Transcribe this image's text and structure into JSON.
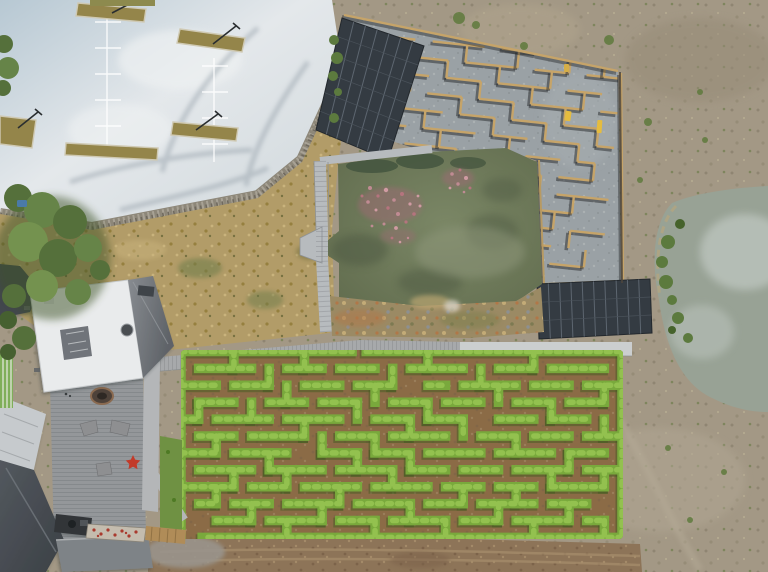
{
  "image": {
    "kind": "aerial-drone-photograph",
    "subject": "maze park seen from above: car park, timber panel maze with solar arrays, green pond with pink water plants, hedge maze with dirt paths, visitor buildings and deck, dry paddock with second pond",
    "width": 768,
    "height": 572
  },
  "colors": {
    "field_base": "#a39885",
    "field_dark": "#8c826f",
    "field_green": "#6d7c4a",
    "parking_light": "#e2e7ea",
    "parking_blue": "#b7c8d3",
    "parking_line": "#ffffff",
    "planter": "#94854a",
    "planter_curb": "#cfc9b3",
    "pole": "#2a2e30",
    "rock_wall": "#8d8779",
    "dry_grass": "#b29c68",
    "tree_green": "#55703b",
    "tree_light": "#6d8a4a",
    "maze_concrete": "#9aa1a5",
    "timber_wall": "#c6a469",
    "timber_shadow": "#26282b",
    "solar": "#343b42",
    "solar_line": "#5d6670",
    "pond_water": "#6f7b60",
    "pond_dark": "#4e5942",
    "pond_light": "#8f977c",
    "flower_pink": "#b5747e",
    "boardwalk": "#b7bbbe",
    "bank_rock": "#9b8a64",
    "path_concrete": "#cbcecf",
    "path_wood": "#a7a9ab",
    "hedge_green": "#79a93c",
    "hedge_highlight": "#93c14f",
    "hedge_shadow": "#3c5a1d",
    "hedge_path": "#8b6b46",
    "deck": "#94979a",
    "roof_white": "#e9ebec",
    "roof_slope": "#71767b",
    "roof_dark": "#42474d",
    "roof_silver": "#c6cacd",
    "roof_flat": "#7e8387",
    "mosaic_base": "#c4bcae",
    "mosaic_red": "#a93a2e",
    "grass_strip": "#6f9143",
    "planter_timber": "#b08c58",
    "dirt": "#8d7458",
    "dirt_light": "#a78e6c",
    "right_pond": "#98a295",
    "cloud_reflection": "#bcc4bd",
    "reed_green": "#5c7a3e",
    "pond_edge_tan": "#b3a57f",
    "bench_yellow": "#e5bc3e",
    "star_red": "#c23b2a",
    "blue_object": "#4a7aa8"
  },
  "scene": {
    "regions": [
      "car-park",
      "timber-maze",
      "solar-arrays",
      "central-pond",
      "boardwalk",
      "hedge-maze",
      "visitor-deck",
      "buildings",
      "dry-field",
      "second-pond",
      "tree-cluster",
      "dirt-ground"
    ]
  },
  "hedge_maze": {
    "ox": 181,
    "oy": 351.5,
    "cellx": 17.64,
    "celly": 16.9,
    "wall_width": 9.5,
    "segments": [
      [
        0,
        0,
        9.7,
        0
      ],
      [
        10.5,
        0,
        25,
        0
      ],
      [
        25,
        0,
        25,
        11
      ],
      [
        25,
        11,
        1.2,
        11
      ],
      [
        0,
        0,
        0,
        11
      ],
      [
        1,
        1,
        4,
        1
      ],
      [
        6,
        1,
        8,
        1
      ],
      [
        9,
        1,
        11,
        1
      ],
      [
        13,
        1,
        16,
        1
      ],
      [
        18,
        1,
        20,
        1
      ],
      [
        21,
        1,
        24,
        1
      ],
      [
        0,
        2,
        2,
        2
      ],
      [
        3,
        2,
        5,
        2
      ],
      [
        7,
        2,
        9,
        2
      ],
      [
        10,
        2,
        12,
        2
      ],
      [
        14,
        2,
        15,
        2
      ],
      [
        16,
        2,
        19,
        2
      ],
      [
        20,
        2,
        22,
        2
      ],
      [
        23,
        2,
        25,
        2
      ],
      [
        1,
        3,
        3,
        3
      ],
      [
        5,
        3,
        7,
        3
      ],
      [
        8,
        3,
        10,
        3
      ],
      [
        12,
        3,
        14,
        3
      ],
      [
        15,
        3,
        17,
        3
      ],
      [
        19,
        3,
        21,
        3
      ],
      [
        22,
        3,
        24,
        3
      ],
      [
        0,
        4,
        1,
        4
      ],
      [
        2,
        4,
        5,
        4
      ],
      [
        6,
        4,
        9,
        4
      ],
      [
        11,
        4,
        13,
        4
      ],
      [
        14,
        4,
        16,
        4
      ],
      [
        18,
        4,
        20,
        4
      ],
      [
        21,
        4,
        23,
        4
      ],
      [
        1,
        5,
        3,
        5
      ],
      [
        4,
        5,
        7,
        5
      ],
      [
        9,
        5,
        11,
        5
      ],
      [
        12,
        5,
        15,
        5
      ],
      [
        17,
        5,
        19,
        5
      ],
      [
        20,
        5,
        22,
        5
      ],
      [
        23,
        5,
        25,
        5
      ],
      [
        0,
        6,
        2,
        6
      ],
      [
        3,
        6,
        6,
        6
      ],
      [
        8,
        6,
        10,
        6
      ],
      [
        11,
        6,
        13,
        6
      ],
      [
        14,
        6,
        17,
        6
      ],
      [
        18,
        6,
        21,
        6
      ],
      [
        22,
        6,
        24,
        6
      ],
      [
        1,
        7,
        4,
        7
      ],
      [
        5,
        7,
        8,
        7
      ],
      [
        9,
        7,
        12,
        7
      ],
      [
        13,
        7,
        15,
        7
      ],
      [
        16,
        7,
        18,
        7
      ],
      [
        19,
        7,
        22,
        7
      ],
      [
        23,
        7,
        25,
        7
      ],
      [
        0,
        8,
        3,
        8
      ],
      [
        4,
        8,
        6,
        8
      ],
      [
        7,
        8,
        10,
        8
      ],
      [
        11,
        8,
        14,
        8
      ],
      [
        15,
        8,
        17,
        8
      ],
      [
        18,
        8,
        20,
        8
      ],
      [
        21,
        8,
        24,
        8
      ],
      [
        1,
        9,
        2,
        9
      ],
      [
        3,
        9,
        5,
        9
      ],
      [
        6,
        9,
        9,
        9
      ],
      [
        10,
        9,
        13,
        9
      ],
      [
        14,
        9,
        16,
        9
      ],
      [
        17,
        9,
        20,
        9
      ],
      [
        21,
        9,
        23,
        9
      ],
      [
        2,
        10,
        4,
        10
      ],
      [
        5,
        10,
        8,
        10
      ],
      [
        9,
        10,
        11,
        10
      ],
      [
        12,
        10,
        15,
        10
      ],
      [
        16,
        10,
        18,
        10
      ],
      [
        19,
        10,
        22,
        10
      ],
      [
        23,
        10,
        24,
        10
      ],
      [
        3,
        0,
        3,
        1
      ],
      [
        7,
        0,
        7,
        1
      ],
      [
        14,
        0,
        14,
        1
      ],
      [
        20,
        0,
        20,
        1
      ],
      [
        5,
        1,
        5,
        2
      ],
      [
        12,
        1,
        12,
        2
      ],
      [
        17,
        1,
        17,
        2
      ],
      [
        6,
        2,
        6,
        3
      ],
      [
        11,
        2,
        11,
        3
      ],
      [
        18,
        2,
        18,
        3
      ],
      [
        24,
        2,
        24,
        3
      ],
      [
        1,
        3,
        1,
        4
      ],
      [
        4,
        3,
        4,
        4
      ],
      [
        10,
        3,
        10,
        4
      ],
      [
        14,
        3,
        14,
        4
      ],
      [
        21,
        3,
        21,
        4
      ],
      [
        7,
        4,
        7,
        5
      ],
      [
        13,
        4,
        13,
        5
      ],
      [
        16,
        4,
        16,
        5
      ],
      [
        24,
        4,
        24,
        5
      ],
      [
        2,
        5,
        2,
        6
      ],
      [
        8,
        5,
        8,
        6
      ],
      [
        11,
        5,
        11,
        6
      ],
      [
        19,
        5,
        19,
        6
      ],
      [
        5,
        6,
        5,
        7
      ],
      [
        10,
        6,
        10,
        7
      ],
      [
        13,
        6,
        13,
        7
      ],
      [
        22,
        6,
        22,
        7
      ],
      [
        3,
        7,
        3,
        8
      ],
      [
        6,
        7,
        6,
        8
      ],
      [
        12,
        7,
        12,
        8
      ],
      [
        21,
        7,
        21,
        8
      ],
      [
        24,
        7,
        24,
        8
      ],
      [
        2,
        8,
        2,
        9
      ],
      [
        9,
        8,
        9,
        9
      ],
      [
        16,
        8,
        16,
        9
      ],
      [
        19,
        8,
        19,
        9
      ],
      [
        4,
        9,
        4,
        10
      ],
      [
        8,
        9,
        8,
        10
      ],
      [
        13,
        9,
        13,
        10
      ],
      [
        18,
        9,
        18,
        10
      ],
      [
        22,
        9,
        22,
        10
      ],
      [
        6,
        10,
        6,
        11
      ],
      [
        11,
        10,
        11,
        11
      ],
      [
        15,
        10,
        15,
        11
      ],
      [
        20,
        10,
        20,
        11
      ],
      [
        24,
        10,
        24,
        11
      ]
    ]
  },
  "timber_maze": {
    "ox": 352,
    "oy": 30,
    "cell": 17.4,
    "wall_width": 2.4,
    "shadow_width": 3.6,
    "shadow_dx": -2,
    "shadow_dy": 2.2,
    "segments": [
      [
        1,
        1,
        3,
        1
      ],
      [
        4,
        1,
        7,
        1
      ],
      [
        8,
        1,
        10,
        1
      ],
      [
        11,
        1,
        13,
        1
      ],
      [
        0,
        2,
        2,
        2
      ],
      [
        3,
        2,
        5,
        2
      ],
      [
        6,
        2,
        9,
        2
      ],
      [
        10,
        2,
        12,
        2
      ],
      [
        13,
        2,
        15,
        2
      ],
      [
        1,
        3,
        4,
        3
      ],
      [
        5,
        3,
        7,
        3
      ],
      [
        8,
        3,
        11,
        3
      ],
      [
        12,
        3,
        14,
        3
      ],
      [
        2,
        4,
        3,
        4
      ],
      [
        4,
        4,
        6,
        4
      ],
      [
        7,
        4,
        9,
        4
      ],
      [
        10,
        4,
        13,
        4
      ],
      [
        14,
        4,
        15,
        4
      ],
      [
        0,
        5,
        1,
        5
      ],
      [
        2,
        5,
        5,
        5
      ],
      [
        6,
        5,
        8,
        5
      ],
      [
        9,
        5,
        11,
        5
      ],
      [
        12,
        5,
        14,
        5
      ],
      [
        1,
        6,
        3,
        6
      ],
      [
        4,
        6,
        7,
        6
      ],
      [
        8,
        6,
        10,
        6
      ],
      [
        11,
        6,
        13,
        6
      ],
      [
        14,
        6,
        15,
        6
      ],
      [
        0,
        7,
        2,
        7
      ],
      [
        3,
        7,
        6,
        7
      ],
      [
        7,
        7,
        9,
        7
      ],
      [
        10,
        7,
        12,
        7
      ],
      [
        13,
        7,
        14,
        7
      ],
      [
        1,
        8,
        4,
        8
      ],
      [
        5,
        8,
        7,
        8
      ],
      [
        8,
        8,
        11,
        8
      ],
      [
        12,
        8,
        14,
        8
      ],
      [
        0,
        9,
        1,
        9
      ],
      [
        2,
        9,
        4,
        9
      ],
      [
        5,
        9,
        8,
        9
      ],
      [
        9,
        9,
        11,
        9
      ],
      [
        12,
        9,
        15,
        9
      ],
      [
        1,
        10,
        3,
        10
      ],
      [
        4,
        10,
        6,
        10
      ],
      [
        7,
        10,
        10,
        10
      ],
      [
        11,
        10,
        13,
        10
      ],
      [
        2,
        11,
        5,
        11
      ],
      [
        6,
        11,
        8,
        11
      ],
      [
        9,
        11,
        12,
        11
      ],
      [
        13,
        11,
        15,
        11
      ],
      [
        0,
        12,
        2,
        12
      ],
      [
        3,
        12,
        6,
        12
      ],
      [
        7,
        12,
        9,
        12
      ],
      [
        10,
        12,
        12,
        12
      ],
      [
        1,
        13,
        4,
        13
      ],
      [
        5,
        13,
        8,
        13
      ],
      [
        9,
        13,
        11,
        13
      ],
      [
        12,
        13,
        14,
        13
      ],
      [
        2,
        1,
        2,
        2
      ],
      [
        6,
        1,
        6,
        2
      ],
      [
        9,
        1,
        9,
        2
      ],
      [
        12,
        1,
        12,
        2
      ],
      [
        14,
        1,
        14,
        2
      ],
      [
        1,
        2,
        1,
        3
      ],
      [
        5,
        2,
        5,
        3
      ],
      [
        8,
        2,
        8,
        3
      ],
      [
        11,
        2,
        11,
        3
      ],
      [
        3,
        3,
        3,
        4
      ],
      [
        7,
        3,
        7,
        4
      ],
      [
        10,
        3,
        10,
        4
      ],
      [
        13,
        3,
        13,
        4
      ],
      [
        2,
        4,
        2,
        5
      ],
      [
        6,
        4,
        6,
        5
      ],
      [
        9,
        4,
        9,
        5
      ],
      [
        12,
        4,
        12,
        5
      ],
      [
        4,
        5,
        4,
        6
      ],
      [
        8,
        5,
        8,
        6
      ],
      [
        11,
        5,
        11,
        6
      ],
      [
        14,
        5,
        14,
        6
      ],
      [
        1,
        6,
        1,
        7
      ],
      [
        5,
        6,
        5,
        7
      ],
      [
        9,
        6,
        9,
        7
      ],
      [
        13,
        6,
        13,
        7
      ],
      [
        2,
        7,
        2,
        8
      ],
      [
        6,
        7,
        6,
        8
      ],
      [
        10,
        7,
        10,
        8
      ],
      [
        14,
        7,
        14,
        8
      ],
      [
        3,
        8,
        3,
        9
      ],
      [
        7,
        8,
        7,
        9
      ],
      [
        11,
        8,
        11,
        9
      ],
      [
        2,
        9,
        2,
        10
      ],
      [
        6,
        9,
        6,
        10
      ],
      [
        10,
        9,
        10,
        10
      ],
      [
        13,
        9,
        13,
        10
      ],
      [
        4,
        10,
        4,
        11
      ],
      [
        8,
        10,
        8,
        11
      ],
      [
        12,
        10,
        12,
        11
      ],
      [
        1,
        11,
        1,
        12
      ],
      [
        5,
        11,
        5,
        12
      ],
      [
        9,
        11,
        9,
        12
      ],
      [
        13,
        11,
        13,
        12
      ],
      [
        3,
        12,
        3,
        13
      ],
      [
        7,
        12,
        7,
        13
      ],
      [
        10,
        12,
        10,
        13
      ],
      [
        14,
        12,
        14,
        13
      ]
    ]
  },
  "pond": {
    "flower_colors": [
      "#c08b93",
      "#b5747e",
      "#d09ba3"
    ],
    "flower_dots": [
      [
        370,
        188,
        2
      ],
      [
        378,
        196,
        1.6
      ],
      [
        386,
        190,
        2.2
      ],
      [
        394,
        200,
        1.8
      ],
      [
        402,
        194,
        2
      ],
      [
        410,
        204,
        1.6
      ],
      [
        398,
        214,
        2
      ],
      [
        388,
        208,
        1.7
      ],
      [
        376,
        210,
        1.5
      ],
      [
        368,
        202,
        1.8
      ],
      [
        406,
        222,
        1.6
      ],
      [
        396,
        228,
        1.9
      ],
      [
        384,
        224,
        1.5
      ],
      [
        414,
        214,
        1.8
      ],
      [
        420,
        206,
        1.5
      ],
      [
        372,
        226,
        1.4
      ],
      [
        362,
        196,
        1.5
      ],
      [
        418,
        196,
        1.4
      ],
      [
        452,
        174,
        1.8
      ],
      [
        460,
        170,
        1.5
      ],
      [
        466,
        178,
        2
      ],
      [
        458,
        184,
        1.7
      ],
      [
        470,
        188,
        1.5
      ],
      [
        450,
        188,
        1.4
      ],
      [
        464,
        192,
        1.3
      ],
      [
        392,
        238,
        1.4
      ],
      [
        400,
        242,
        1.3
      ],
      [
        408,
        238,
        1.2
      ]
    ]
  }
}
